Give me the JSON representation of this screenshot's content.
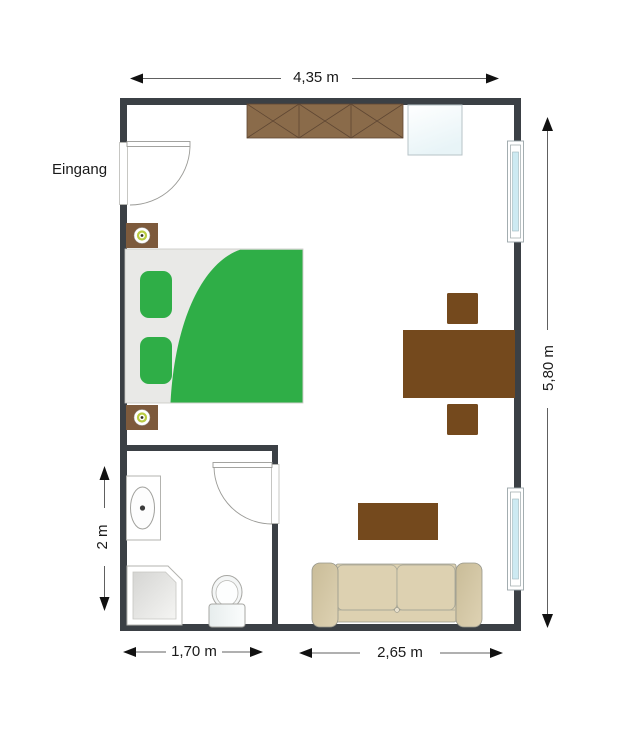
{
  "page": {
    "background": "#ffffff",
    "type": "apartment-floor-plan"
  },
  "labels": {
    "entrance": "Eingang"
  },
  "dimensions": {
    "room_width": "4,35 m",
    "room_height": "5,80 m",
    "bathroom_height": "2 m",
    "bathroom_width": "1,70 m",
    "living_area_width": "2,65 m"
  },
  "colors": {
    "wall": "#3b4045",
    "woodDark": "#74491d",
    "woodMid": "#8a6b4a",
    "woodLine": "#5f4733",
    "woodNight": "#7d5a3c",
    "green": "#2fae47",
    "sheet": "#e9e9e7",
    "sofa": "#ddd1b1",
    "sofaArm": "#cfc3a2",
    "sofaLine": "#96968a",
    "glass": "#cdeaf2",
    "dimLine": "#606060",
    "arrow": "#111111",
    "text": "#1a1a1a",
    "fixture": "#aeaeaa"
  },
  "furniture_icons": [
    "wardrobe-icon",
    "minibar-cabinet-icon",
    "double-bed-icon",
    "pillow-icon",
    "nightstand-lamp-icon",
    "dining-table-icon",
    "chair-icon",
    "coffee-table-icon",
    "sofa-icon",
    "washbasin-icon",
    "shower-icon",
    "toilet-icon"
  ],
  "opening_icons": [
    "entrance-door-icon",
    "bathroom-door-icon",
    "window-icon",
    "window-icon"
  ]
}
